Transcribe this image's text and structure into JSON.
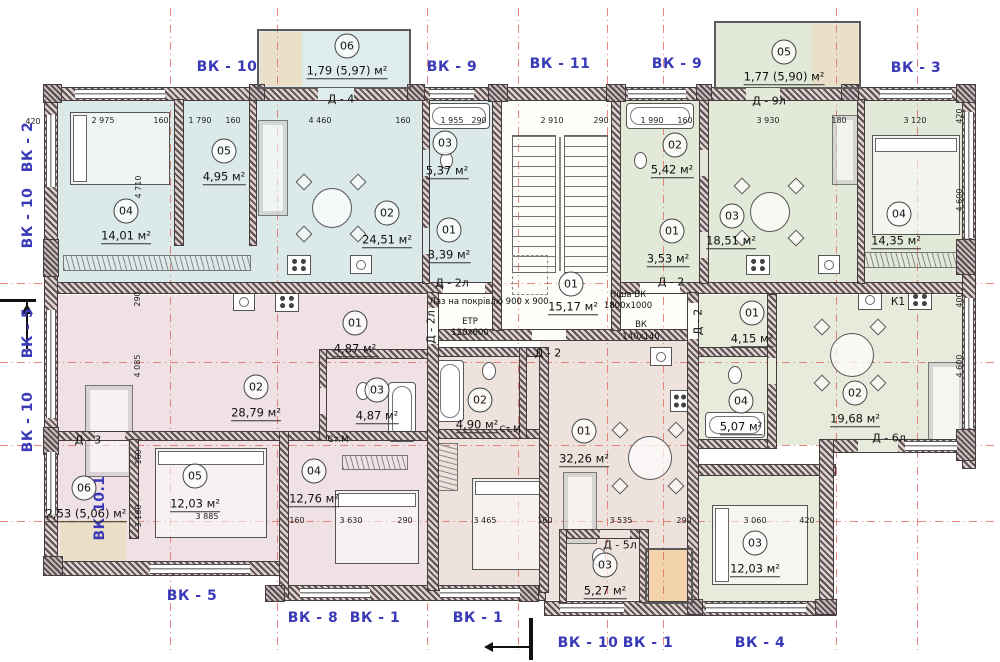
{
  "colors": {
    "axis_red": "#e06a5f",
    "label_blue": "#3a3ab8",
    "wall_dark": "#4a4045",
    "fill_blue": "#dbe9e9",
    "fill_green": "#e3e9d8",
    "fill_pink": "#efe1e4",
    "fill_beige": "#ede2dc",
    "fill_green2": "#e7ebdc",
    "fill_tan": "#ecdfc8",
    "fill_orange": "#f3d3ab",
    "corridor": "#fdfdf9"
  },
  "axis_labels": [
    {
      "t": "ВК - 10",
      "x": 227,
      "y": 67
    },
    {
      "t": "ВК - 9",
      "x": 452,
      "y": 67
    },
    {
      "t": "ВК - 11",
      "x": 560,
      "y": 64
    },
    {
      "t": "ВК - 9",
      "x": 677,
      "y": 64
    },
    {
      "t": "ВК - 3",
      "x": 916,
      "y": 68
    },
    {
      "t": "ВК - 2",
      "x": 28,
      "y": 147,
      "v": 1
    },
    {
      "t": "ВК - 10",
      "x": 28,
      "y": 218,
      "v": 1
    },
    {
      "t": "ВК - 5",
      "x": 28,
      "y": 333,
      "v": 1
    },
    {
      "t": "ВК - 10",
      "x": 28,
      "y": 422,
      "v": 1
    },
    {
      "t": "ВК 10.1",
      "x": 100,
      "y": 508,
      "v": 1
    },
    {
      "t": "ВК - 5",
      "x": 192,
      "y": 596
    },
    {
      "t": "ВК - 8",
      "x": 313,
      "y": 618
    },
    {
      "t": "ВК - 1",
      "x": 375,
      "y": 618
    },
    {
      "t": "ВК - 1",
      "x": 478,
      "y": 618
    },
    {
      "t": "ВК - 10",
      "x": 588,
      "y": 643
    },
    {
      "t": "ВК - 1",
      "x": 648,
      "y": 643
    },
    {
      "t": "ВК - 4",
      "x": 760,
      "y": 643
    }
  ],
  "rooms": [
    {
      "num": "06",
      "cx": 347,
      "cy": 46,
      "area": "1,79 (5,97) м²",
      "ax": 347,
      "ay": 72
    },
    {
      "num": "05",
      "cx": 784,
      "cy": 52,
      "area": "1,77 (5,90) м²",
      "ax": 784,
      "ay": 78
    },
    {
      "num": "04",
      "cx": 126,
      "cy": 211,
      "area": "14,01 м²",
      "ax": 126,
      "ay": 237
    },
    {
      "num": "05",
      "cx": 224,
      "cy": 151,
      "area": "4,95 м²",
      "ax": 224,
      "ay": 178
    },
    {
      "num": "02",
      "cx": 387,
      "cy": 213,
      "area": "24,51 м²",
      "ax": 387,
      "ay": 241
    },
    {
      "num": "03",
      "cx": 445,
      "cy": 143,
      "area": "5,37 м²",
      "ax": 447,
      "ay": 172
    },
    {
      "num": "01",
      "cx": 449,
      "cy": 230,
      "area": "3,39 м²",
      "ax": 449,
      "ay": 256
    },
    {
      "num": "01",
      "cx": 571,
      "cy": 284,
      "area": "15,17 м²",
      "ax": 573,
      "ay": 308
    },
    {
      "num": "02",
      "cx": 675,
      "cy": 145,
      "area": "5,42 м²",
      "ax": 672,
      "ay": 171
    },
    {
      "num": "01",
      "cx": 672,
      "cy": 231,
      "area": "3,53 м²",
      "ax": 668,
      "ay": 260
    },
    {
      "num": "03",
      "cx": 732,
      "cy": 216,
      "area": "18,51 м²",
      "ax": 731,
      "ay": 242
    },
    {
      "num": "04",
      "cx": 899,
      "cy": 214,
      "area": "14,35 м²",
      "ax": 896,
      "ay": 242
    },
    {
      "num": "02",
      "cx": 256,
      "cy": 387,
      "area": "28,79 м²",
      "ax": 256,
      "ay": 414
    },
    {
      "num": "01",
      "cx": 355,
      "cy": 323,
      "area": "4,87 м²",
      "ax": 355,
      "ay": 350
    },
    {
      "num": "03",
      "cx": 377,
      "cy": 390,
      "area": "4,87 м²",
      "ax": 377,
      "ay": 417
    },
    {
      "num": "05",
      "cx": 195,
      "cy": 476,
      "area": "12,03 м²",
      "ax": 195,
      "ay": 505
    },
    {
      "num": "04",
      "cx": 314,
      "cy": 471,
      "area": "12,76 м²",
      "ax": 314,
      "ay": 500
    },
    {
      "num": "06",
      "cx": 84,
      "cy": 488,
      "area": "2,53 (5,06) м²",
      "ax": 86,
      "ay": 515
    },
    {
      "num": "02",
      "cx": 480,
      "cy": 400,
      "area": "4,90 м²",
      "ax": 477,
      "ay": 426
    },
    {
      "num": "01",
      "cx": 584,
      "cy": 431,
      "area": "32,26 м²",
      "ax": 584,
      "ay": 460
    },
    {
      "num": "03",
      "cx": 605,
      "cy": 565,
      "area": "5,27 м²",
      "ax": 605,
      "ay": 592
    },
    {
      "num": "01",
      "cx": 752,
      "cy": 313,
      "area": "4,15 м²",
      "ax": 752,
      "ay": 340
    },
    {
      "num": "04",
      "cx": 741,
      "cy": 401,
      "area": "5,07 м²",
      "ax": 741,
      "ay": 428
    },
    {
      "num": "02",
      "cx": 855,
      "cy": 393,
      "area": "19,68 м²",
      "ax": 855,
      "ay": 420
    },
    {
      "num": "03",
      "cx": 755,
      "cy": 543,
      "area": "12,03 м²",
      "ax": 755,
      "ay": 570
    }
  ],
  "door_labels": [
    {
      "t": "Д - 4",
      "x": 341,
      "y": 99
    },
    {
      "t": "Д - 9л",
      "x": 769,
      "y": 101
    },
    {
      "t": "Д - 2л",
      "x": 452,
      "y": 283
    },
    {
      "t": "Д - 2л",
      "x": 431,
      "y": 327,
      "v": 1
    },
    {
      "t": "Д - 2",
      "x": 671,
      "y": 282
    },
    {
      "t": "Д - 2",
      "x": 548,
      "y": 353
    },
    {
      "t": "Д - 2",
      "x": 698,
      "y": 322,
      "v": 1
    },
    {
      "t": "Д - 3",
      "x": 88,
      "y": 440
    },
    {
      "t": "Д - 5л",
      "x": 620,
      "y": 545
    },
    {
      "t": "Д - 6л",
      "x": 889,
      "y": 438
    }
  ],
  "annotations": [
    {
      "t": "Лаз на покрівлю 900 х 900",
      "x": 489,
      "y": 302
    },
    {
      "t": "ЕТР",
      "x": 470,
      "y": 322
    },
    {
      "t": "120х600",
      "x": 470,
      "y": 333
    },
    {
      "t": "Ніша ВК",
      "x": 628,
      "y": 295
    },
    {
      "t": "1800х1000",
      "x": 628,
      "y": 306
    },
    {
      "t": "ВК",
      "x": 641,
      "y": 325
    },
    {
      "t": "140х140",
      "x": 641,
      "y": 337
    },
    {
      "t": "К1",
      "x": 898,
      "y": 302,
      "b": 1
    },
    {
      "t": "Ст.М",
      "x": 338,
      "y": 440
    },
    {
      "t": "Ст.М",
      "x": 510,
      "y": 430
    }
  ],
  "dimensions": [
    {
      "t": "420",
      "x": 33,
      "y": 122
    },
    {
      "t": "2 975",
      "x": 103,
      "y": 121
    },
    {
      "t": "160",
      "x": 161,
      "y": 121
    },
    {
      "t": "1 790",
      "x": 200,
      "y": 121
    },
    {
      "t": "160",
      "x": 233,
      "y": 121
    },
    {
      "t": "4 460",
      "x": 320,
      "y": 121
    },
    {
      "t": "160",
      "x": 403,
      "y": 121
    },
    {
      "t": "1 955",
      "x": 452,
      "y": 121
    },
    {
      "t": "290",
      "x": 479,
      "y": 121
    },
    {
      "t": "2 910",
      "x": 552,
      "y": 121
    },
    {
      "t": "290",
      "x": 601,
      "y": 121
    },
    {
      "t": "1 990",
      "x": 652,
      "y": 121
    },
    {
      "t": "160",
      "x": 685,
      "y": 121
    },
    {
      "t": "3 930",
      "x": 768,
      "y": 121
    },
    {
      "t": "180",
      "x": 839,
      "y": 121
    },
    {
      "t": "3 120",
      "x": 915,
      "y": 121
    },
    {
      "t": "420",
      "x": 960,
      "y": 116,
      "v": 1
    },
    {
      "t": "4 600",
      "x": 960,
      "y": 200,
      "v": 1
    },
    {
      "t": "400",
      "x": 960,
      "y": 300,
      "v": 1
    },
    {
      "t": "4 600",
      "x": 960,
      "y": 366,
      "v": 1
    },
    {
      "t": "4 710",
      "x": 139,
      "y": 187,
      "v": 1
    },
    {
      "t": "290",
      "x": 138,
      "y": 299,
      "v": 1
    },
    {
      "t": "4 085",
      "x": 138,
      "y": 366,
      "v": 1
    },
    {
      "t": "160",
      "x": 139,
      "y": 457,
      "v": 1
    },
    {
      "t": "3 160",
      "x": 139,
      "y": 516,
      "v": 1
    },
    {
      "t": "160",
      "x": 297,
      "y": 521
    },
    {
      "t": "3 630",
      "x": 351,
      "y": 521
    },
    {
      "t": "290",
      "x": 405,
      "y": 521
    },
    {
      "t": "3 465",
      "x": 485,
      "y": 521
    },
    {
      "t": "160",
      "x": 545,
      "y": 521
    },
    {
      "t": "3 535",
      "x": 621,
      "y": 521
    },
    {
      "t": "290",
      "x": 684,
      "y": 521
    },
    {
      "t": "3 060",
      "x": 755,
      "y": 521
    },
    {
      "t": "420",
      "x": 807,
      "y": 521
    },
    {
      "t": "3 885",
      "x": 207,
      "y": 517
    }
  ]
}
